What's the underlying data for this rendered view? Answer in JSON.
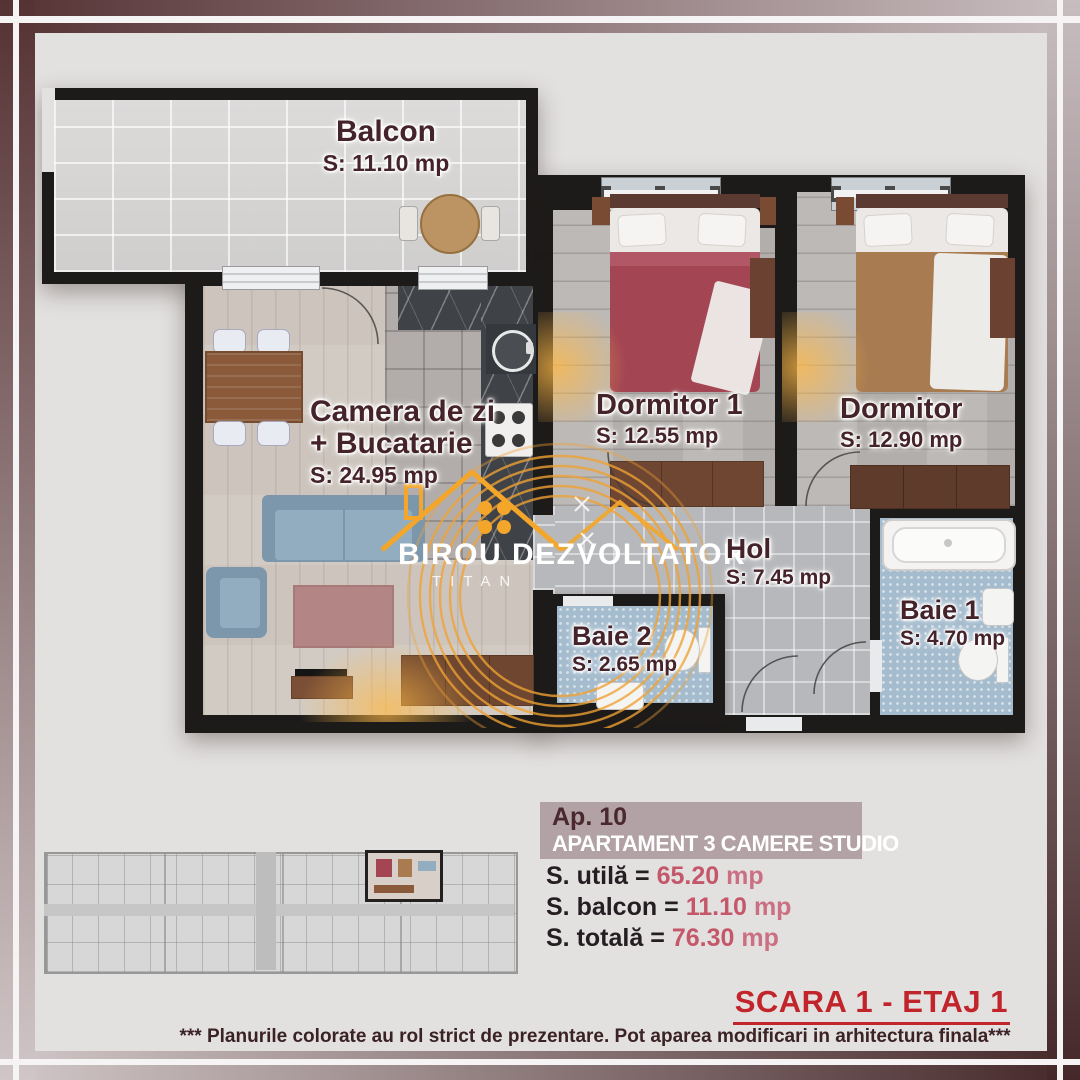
{
  "plan": {
    "rooms": [
      {
        "name": "Balcon",
        "s": "S:",
        "value": "11.10",
        "unit": "mp"
      },
      {
        "name": "Camera de zi",
        "name2": "+ Bucatarie",
        "s": "S:",
        "value": "24.95",
        "unit": "mp"
      },
      {
        "name": "Dormitor 1",
        "s": "S:",
        "value": "12.55",
        "unit": "mp"
      },
      {
        "name": "Dormitor",
        "s": "S:",
        "value": "12.90",
        "unit": "mp"
      },
      {
        "name": "Hol",
        "s": "S:",
        "value": "7.45",
        "unit": "mp"
      },
      {
        "name": "Baie 2",
        "s": "S:",
        "value": "2.65",
        "unit": "mp"
      },
      {
        "name": "Baie 1",
        "s": "S:",
        "value": "4.70",
        "unit": "mp"
      }
    ],
    "watermark": {
      "brand": "BIROU DEZVOLTATOR",
      "sub": "TITAN"
    }
  },
  "info": {
    "ap": "Ap. 10",
    "type": "APARTAMENT 3 CAMERE STUDIO",
    "rows": [
      {
        "label": "S. utilă",
        "eq": "=",
        "value": "65.20",
        "unit": "mp"
      },
      {
        "label": "S. balcon",
        "eq": "=",
        "value": "11.10",
        "unit": "mp"
      },
      {
        "label": "S. totală",
        "eq": "=",
        "value": "76.30",
        "unit": "mp"
      }
    ]
  },
  "footer": {
    "scara": "SCARA 1 - ETAJ 1",
    "disclaimer": "*** Planurile colorate au rol strict de prezentare. Pot aparea modificari in arhitectura finala***"
  },
  "colors": {
    "accent_red": "#c2242b",
    "label_maroon": "#45232a",
    "value_rose": "#c4586a",
    "band_mauve": "#b2a1a5",
    "watermark_orange": "#f0a233",
    "wall_black": "#1d1b1a"
  }
}
